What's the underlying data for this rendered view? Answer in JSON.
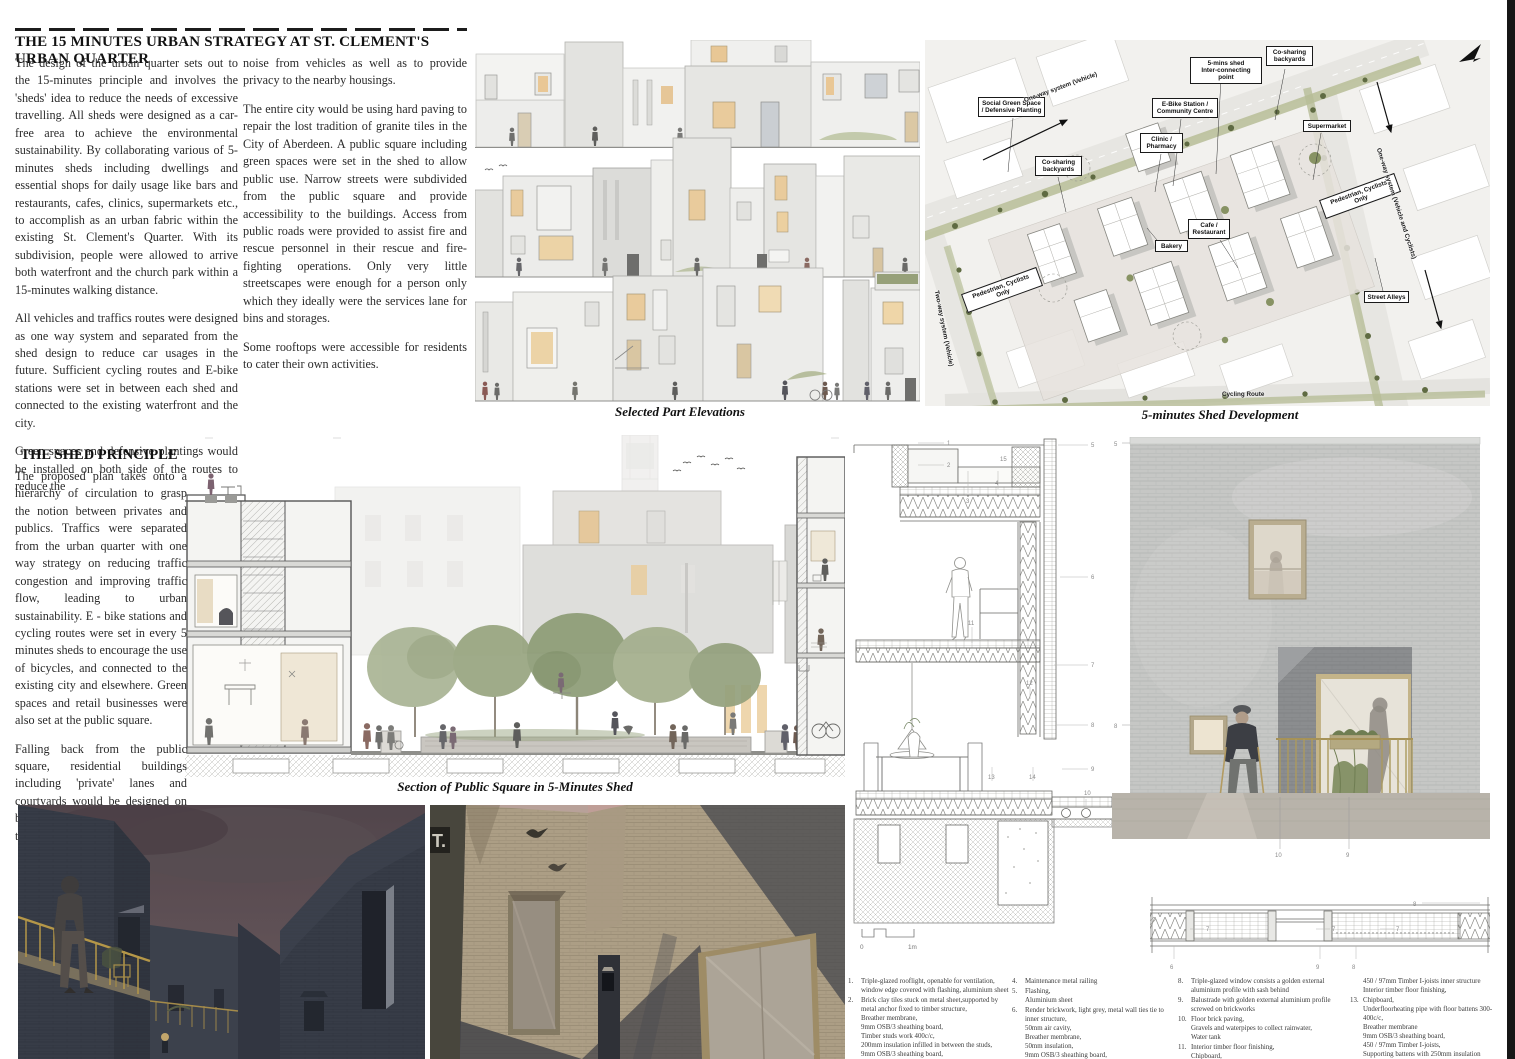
{
  "strategy": {
    "title": "THE 15 MINUTES URBAN STRATEGY AT ST. CLEMENT'S URBAN QUARTER",
    "col1": [
      "The design of the urban quarter sets out to the 15-minutes principle and involves the 'sheds' idea to reduce the needs of excessive travelling. All sheds were designed as a car-free area to achieve the environmental sustainability. By collaborating various of 5-minutes sheds including dwellings and essential shops for daily usage like bars and restaurants, cafes, clinics, supermarkets etc., to accomplish as an urban fabric within the existing St. Clement's Quarter. With its subdivision, people were allowed to arrive both waterfront and the church park within a 15-minutes walking distance.",
      "All vehicles and traffics routes were designed as one way system and separated from the shed design to reduce car usages in the future. Sufficient cycling routes and E-bike stations were set in between each shed and connected to the existing waterfront and the city.",
      "Green spaces and defensive plantings would be installed on both side of the routes to reduce the"
    ],
    "col2": [
      "noise from vehicles as well as to provide privacy to the nearby housings.",
      "The entire city would be using hard paving to repair the lost tradition of granite tiles in the City of Aberdeen. A public square including green spaces were set in the shed to allow public use. Narrow streets were subdivided from the public square and provide accessibility to the buildings. Access from public roads were provided to assist fire and rescue personnel in their rescue and fire-fighting operations. Only very little streetscapes were enough for a person only which they ideally were the services lane for bins and storages.",
      "Some rooftops were accessible for residents to cater their own activities."
    ]
  },
  "shed_principle": {
    "title": "THE SHED PRINCIPLE",
    "paragraphs": [
      "The proposed plan takes onto a hierarchy of circulation to grasp the notion between privates and publics. Traffics were separated from the urban quarter with one way strategy on reducing traffic congestion and improving traffic flow, leading to urban sustainability. E - bike stations and cycling routes were set in every 5 minutes sheds to encourage the use of bicycles, and connected  to the existing city and elsewhere. Green spaces and retail businesses were also set at the public square.",
      "Falling back from the public square, residential buildings including 'private' lanes and courtyards would be designed on both sides for residents to cater their own activities."
    ]
  },
  "elevations": {
    "caption": "Selected Part Elevations"
  },
  "site_plan": {
    "caption": "5-minutes Shed Development",
    "labels": {
      "social_green": "Social Green Space\n/ Defensive Planting",
      "cosharing_left": "Co-sharing\nbackyards",
      "cosharing_right": "Co-sharing\nbackyards",
      "five_mins_shed": "5-mins shed\nInter-connecting point",
      "ebike": "E-Bike Station /\nCommunity Centre",
      "supermarket": "Supermarket",
      "clinic": "Clinic /\nPharmacy",
      "cafe": "Cafe /\nRestaurant",
      "bakery": "Bakery",
      "pedestrian_left": "Pedestrian, Cyclists Only",
      "pedestrian_right": "Pedestrian, Cyclists Only",
      "street_alleys": "Street Alleys",
      "one_way_vehicle": "One-way system (Vehicle)",
      "one_way_vehicle_cyclists": "One-way system (Vehicle and Cyclists)",
      "two_way_vehicle": "Two-way system (Vehicle)",
      "cycling_route": "Cycling Route"
    }
  },
  "section": {
    "caption": "Section of Public Square in 5-Minutes Shed"
  },
  "detail_section": {
    "callouts": {
      "one": "1",
      "two": "2",
      "three": "3",
      "four": "4",
      "five": "5",
      "six": "6",
      "seven": "7",
      "eight": "8",
      "nine": "9",
      "ten": "10",
      "eleven": "11",
      "twelve": "12",
      "thirteen": "13",
      "fourteen": "14",
      "fifteen": "15"
    },
    "scale": {
      "zero": "0",
      "one_m": "1m"
    }
  },
  "facade": {
    "callouts": {
      "five": "5",
      "eight": "8",
      "nine": "9",
      "ten": "10"
    }
  },
  "plan_detail": {
    "callouts": {
      "six": "6",
      "seven": "7",
      "eight": "8",
      "nine": "9"
    }
  },
  "legend": {
    "col1": [
      {
        "n": "1.",
        "t": "Triple-glazed rooflight, openable for ventilation, window edge covered with flashing, aluminium sheet"
      },
      {
        "n": "2.",
        "t": "Brick clay tiles stuck on metal sheet,supported by metal anchor fixed to timber structure,\nBreather membrane,\n9mm OSB/3 sheathing board,\nTimber studs work 400c/c,\n200mm insulation infilled in between the studs,\n9mm OSB/3 sheathing board,\nVapour Barrier,"
      }
    ],
    "col2": [
      {
        "n": "4.",
        "t": "Maintenance metal railing"
      },
      {
        "n": "5.",
        "t": "Flashing,\nAluminium sheet"
      },
      {
        "n": "6.",
        "t": "Render brickwork, light grey, metal wall ties tie to inner structure,\n50mm air cavity,\nBreather membrane,\n50mm insulation,\n9mm OSB/3 sheathing board,\n450 / 97mm Timber I-joists,"
      }
    ],
    "col3": [
      {
        "n": "8.",
        "t": "Triple-glazed window consists a golden external aluminium profile with sash behind"
      },
      {
        "n": "9.",
        "t": "Balustrade with golden external aluminium profile screwed on brickworks"
      },
      {
        "n": "10.",
        "t": "Floor brick paving,\nGravels and waterpipes to collect rainwater,\nWater tank"
      },
      {
        "n": "11.",
        "t": "Interior timber floor finishing,\nChipboard,\nUnderfloorheating pipe with floor battens 300-400c/c,"
      }
    ],
    "col4": [
      {
        "n": "",
        "t": "450 / 97mm Timber I-joists inner structure\nInterior timber floor finishing,"
      },
      {
        "n": "13.",
        "t": "Chipboard,\nUnderfloorheating pipe with floor battens 300-400c/c,\nBreather membrane\n9mm OSB/3 sheathing board,\n450 / 97mm Timber I-joists,\nSupporting battens with 250mm insulation\n9mm OSB/3 sheathing board,\nBreather membrane,"
      }
    ]
  }
}
